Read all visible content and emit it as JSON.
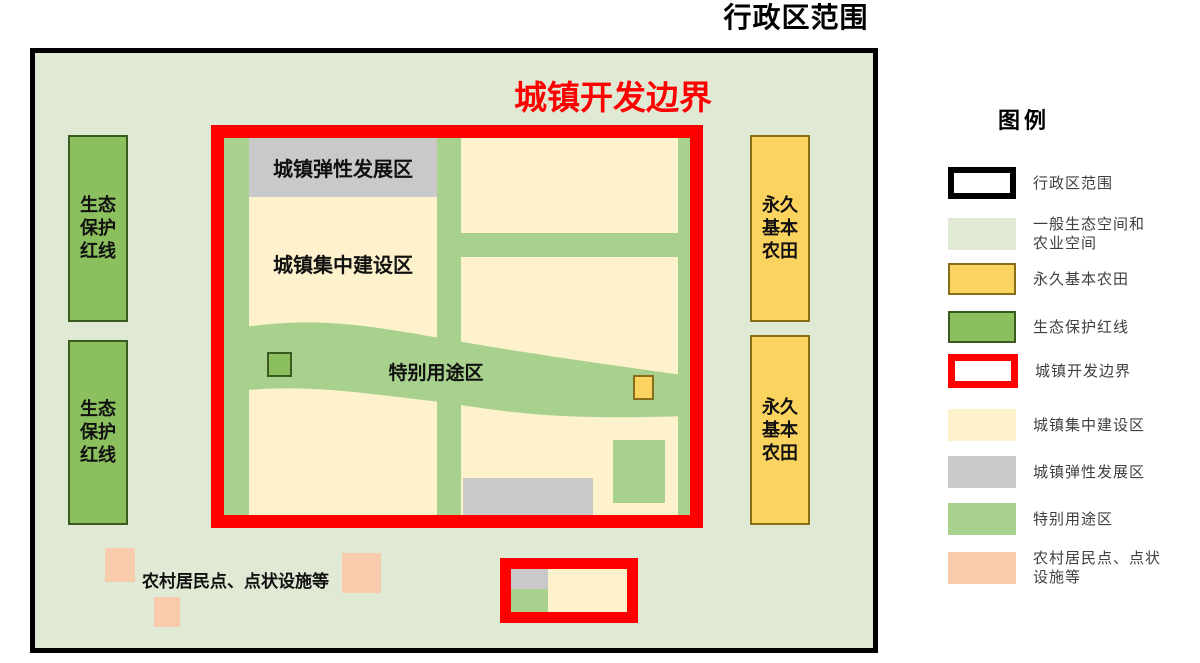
{
  "colors": {
    "page_bg": "#ffffff",
    "eco_agri_space": "#dfe9d3",
    "special_use_green": "#a9d18e",
    "eco_redline_green": "#8cc05e",
    "eco_redline_border": "#3a5a20",
    "built_up_cream": "#fdf2cc",
    "elastic_gray": "#c9c9c9",
    "farmland_yellow": "#fbd35f",
    "farmland_border": "#8a6d1a",
    "rural_pink": "#f8cbad",
    "boundary_red": "#fe0000",
    "admin_black": "#000000",
    "legend_text": "#3f3f3f",
    "map_label": "#111111"
  },
  "map": {
    "admin_title": "行政区范围",
    "ugb_title": "城镇开发边界",
    "elastic_label": "城镇弹性发展区",
    "concentrated_label": "城镇集中建设区",
    "special_label": "特别用途区",
    "rural_label": "农村居民点、点状设施等",
    "eco_redline_lines": [
      "生态",
      "保护",
      "红线"
    ],
    "farmland_lines": [
      "永久",
      "基本",
      "农田"
    ]
  },
  "legend": {
    "title": "图例",
    "items": [
      {
        "name": "admin-region",
        "label": "行政区范围",
        "lines": [
          "行政区范围"
        ],
        "swatch": "admin"
      },
      {
        "name": "general-eco-agri-space",
        "label": "一般生态空间和农业空间",
        "lines": [
          "一般生态空间和",
          "农业空间"
        ],
        "swatch": "eco-space"
      },
      {
        "name": "permanent-basic-farmland",
        "label": "永久基本农田",
        "lines": [
          "永久基本农田"
        ],
        "swatch": "farmland"
      },
      {
        "name": "eco-protection-redline",
        "label": "生态保护红线",
        "lines": [
          "生态保护红线"
        ],
        "swatch": "eco-redline"
      },
      {
        "name": "urban-development-boundary",
        "label": "城镇开发边界",
        "lines": [
          "城镇开发边界"
        ],
        "swatch": "ugb"
      },
      {
        "name": "urban-concentrated-construction",
        "label": "城镇集中建设区",
        "lines": [
          "城镇集中建设区"
        ],
        "swatch": "concentrated"
      },
      {
        "name": "urban-elastic-development",
        "label": "城镇弹性发展区",
        "lines": [
          "城镇弹性发展区"
        ],
        "swatch": "elastic"
      },
      {
        "name": "special-use-area",
        "label": "特别用途区",
        "lines": [
          "特别用途区"
        ],
        "swatch": "special"
      },
      {
        "name": "rural-settlements-point-facilities",
        "label": "农村居民点、点状设施等",
        "lines": [
          "农村居民点、点状",
          "设施等"
        ],
        "swatch": "rural"
      }
    ]
  }
}
